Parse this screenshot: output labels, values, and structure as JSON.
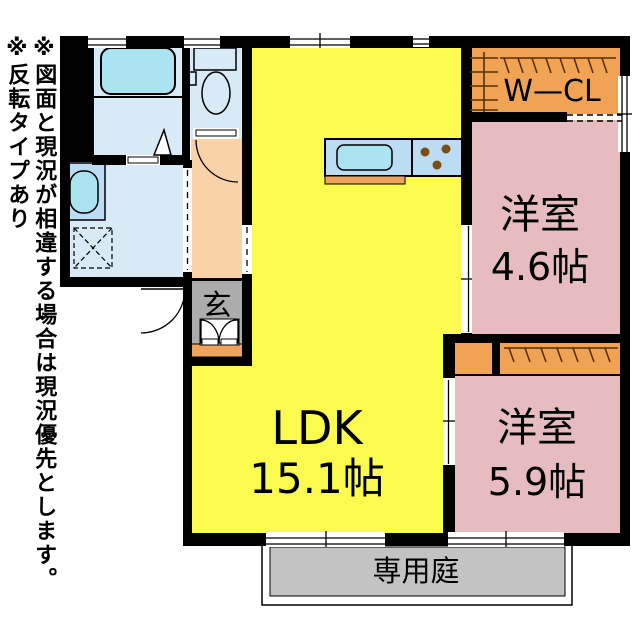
{
  "floorplan": {
    "notes": [
      "※図面と現況が相違する場合は現況優先とします。",
      "※反転タイプあり"
    ],
    "rooms": {
      "ldk": {
        "label": "LDK",
        "size": "15.1帖"
      },
      "bedroom1": {
        "label": "洋室",
        "size": "4.6帖"
      },
      "bedroom2": {
        "label": "洋室",
        "size": "5.9帖"
      },
      "walk_in_closet": {
        "label": "W—CL"
      },
      "entrance": {
        "label": "玄"
      },
      "private_garden": {
        "label": "専用庭"
      }
    },
    "colors": {
      "ldk": "#FBFB4F",
      "bedroom": "#E6BCC0",
      "closet": "#F0A355",
      "hallway": "#F9D3A7",
      "bathroom": "#D8EAF6",
      "fixture": "#A9E4F0",
      "counter": "#BCDCF4",
      "entrance": "#ACACAC",
      "garden": "#C3C3C3",
      "step": "#F0A35C",
      "burner": "#7C4E12",
      "wall": "#000000"
    }
  }
}
